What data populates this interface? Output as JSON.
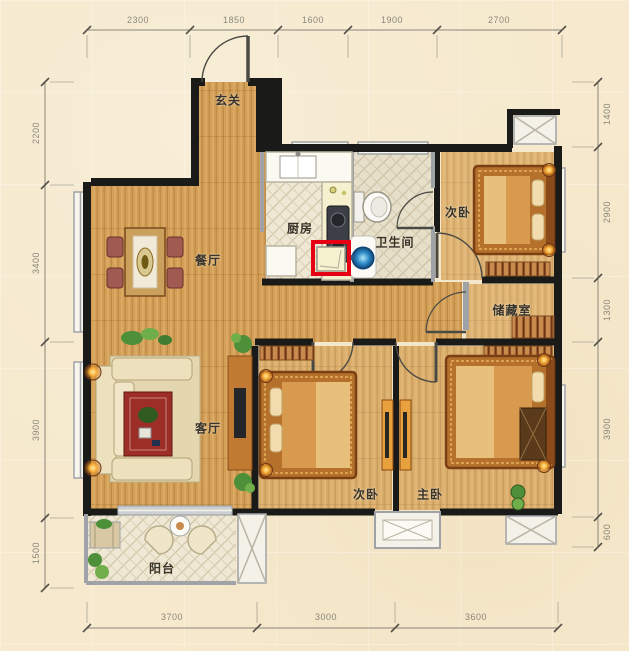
{
  "plan": {
    "rooms": {
      "entry": "玄关",
      "kitchen": "厨房",
      "bathroom": "卫生间",
      "bedroom_top": "次卧",
      "dining": "餐厅",
      "storage": "储藏室",
      "living": "客厅",
      "bedroom_bottom": "次卧",
      "master": "主卧",
      "balcony": "阳台"
    },
    "dimensions": {
      "top": [
        "2300",
        "1850",
        "1600",
        "1900",
        "2700"
      ],
      "bottom": [
        "3700",
        "3000",
        "3600"
      ],
      "left": [
        "2200",
        "3400",
        "3900",
        "1500"
      ],
      "right": [
        "1400",
        "2900",
        "1300",
        "3900",
        "600"
      ]
    },
    "highlight": {
      "color": "#e60013"
    },
    "colors": {
      "background": "#f6e9cd",
      "wall": "#1a1a18",
      "wood_floor": "#d4a057",
      "tile_floor": "#efe8d4",
      "accent_red": "#e60013"
    }
  }
}
